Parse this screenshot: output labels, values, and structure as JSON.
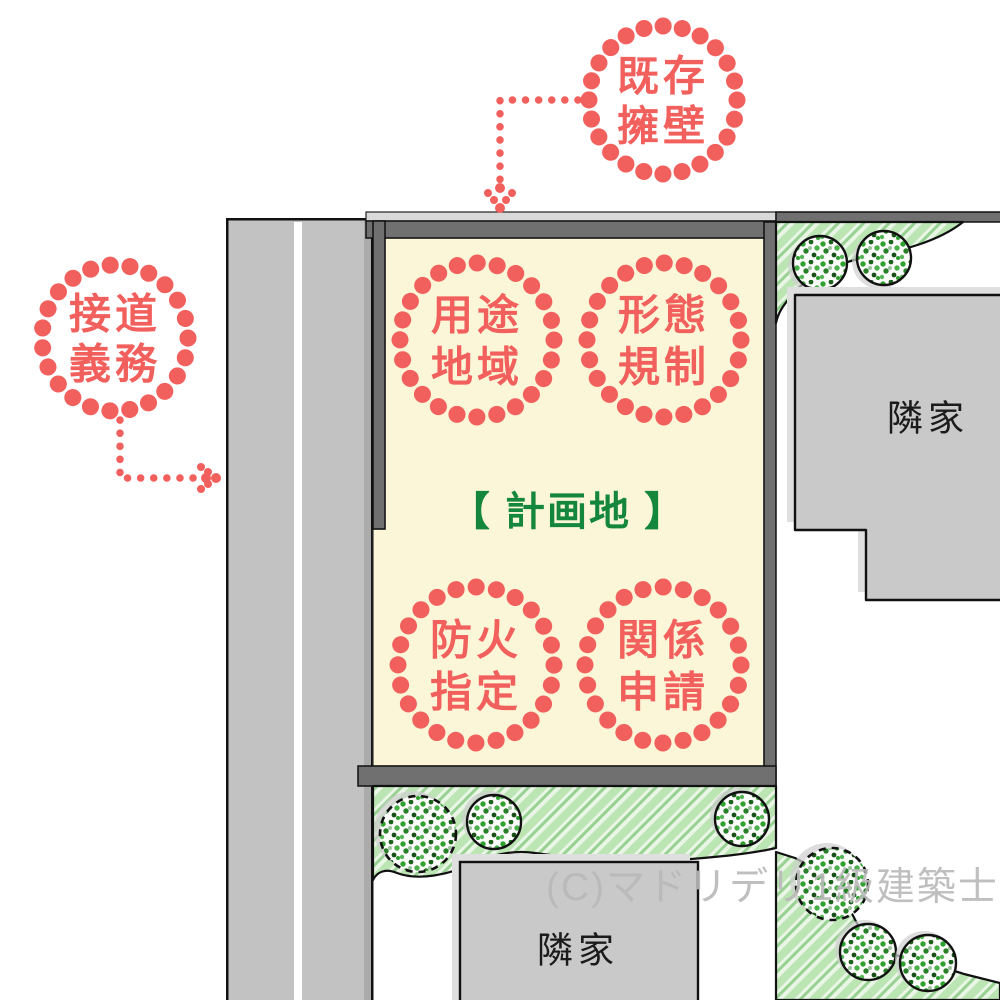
{
  "diagram_title": "site-plan-zoning-diagram",
  "colors": {
    "red": "#F2605D",
    "green_text": "#15873C",
    "site_fill": "#FBF6D8",
    "road": "#C2C2C2",
    "road_edge": "#ABABAB",
    "wall": "#707070",
    "wall_top": "#D9D9D9",
    "building": "#C9C9C9",
    "building_bevel": "#DFDFDF",
    "outline": "#111111",
    "hatch_bg": "#E9F5E5",
    "hatch_stripe": "#BCE5B4",
    "watermark_gray": "#B9B9B9"
  },
  "site": {
    "label": "【 計画地 】"
  },
  "callouts": {
    "existing_wall": {
      "line1": "既存",
      "line2": "擁壁"
    },
    "road_duty": {
      "line1": "接道",
      "line2": "義務"
    },
    "use_district": {
      "line1": "用途",
      "line2": "地域"
    },
    "form_regulation": {
      "line1": "形態",
      "line2": "規制"
    },
    "fire_designation": {
      "line1": "防火",
      "line2": "指定"
    },
    "related_application": {
      "line1": "関係",
      "line2": "申請"
    }
  },
  "neighbors": {
    "right_label": "隣家",
    "bottom_label": "隣家"
  },
  "watermark": "(C)マドリデリ1級建築士事務所"
}
